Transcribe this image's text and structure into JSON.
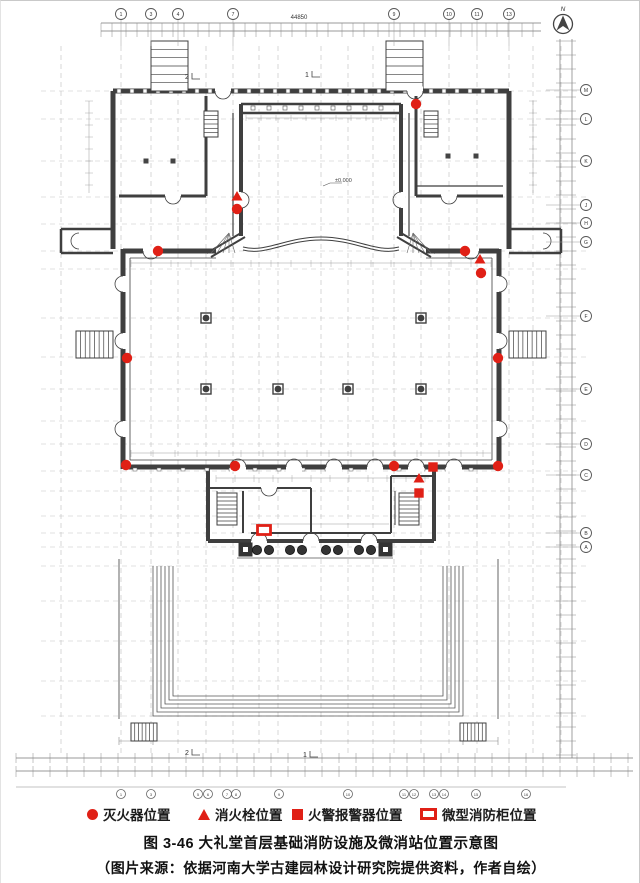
{
  "colors": {
    "red": "#e02016",
    "line": "#3f3f3f"
  },
  "compass": {
    "label": "N"
  },
  "dimensions": {
    "overall_width": "44850"
  },
  "annotations": {
    "level": "±0.000",
    "sections": [
      {
        "x": 186,
        "y": 78,
        "label": "2"
      },
      {
        "x": 306,
        "y": 76,
        "label": "1"
      },
      {
        "x": 186,
        "y": 754,
        "label": "2"
      },
      {
        "x": 304,
        "y": 756,
        "label": "1"
      }
    ]
  },
  "grid": {
    "top_bubbles": [
      {
        "x": 120,
        "label": "1"
      },
      {
        "x": 150,
        "label": "3"
      },
      {
        "x": 177,
        "label": "4"
      },
      {
        "x": 232,
        "label": "7"
      },
      {
        "x": 393,
        "label": "9"
      },
      {
        "x": 448,
        "label": "10"
      },
      {
        "x": 476,
        "label": "11"
      },
      {
        "x": 508,
        "label": "13"
      }
    ],
    "right_bubbles": [
      {
        "y": 89,
        "label": "M"
      },
      {
        "y": 118,
        "label": "L"
      },
      {
        "y": 160,
        "label": "K"
      },
      {
        "y": 204,
        "label": "J"
      },
      {
        "y": 222,
        "label": "H"
      },
      {
        "y": 241,
        "label": "G"
      },
      {
        "y": 315,
        "label": "F"
      },
      {
        "y": 388,
        "label": "E"
      },
      {
        "y": 443,
        "label": "D"
      },
      {
        "y": 474,
        "label": "C"
      },
      {
        "y": 532,
        "label": "B"
      },
      {
        "y": 546,
        "label": "A"
      }
    ],
    "bottom_bubbles": [
      {
        "x": 120,
        "label": "1"
      },
      {
        "x": 150,
        "label": "3"
      },
      {
        "x": 197,
        "label": "5"
      },
      {
        "x": 207,
        "label": "6"
      },
      {
        "x": 226,
        "label": "7"
      },
      {
        "x": 235,
        "label": "8"
      },
      {
        "x": 278,
        "label": "9"
      },
      {
        "x": 347,
        "label": "10"
      },
      {
        "x": 403,
        "label": "11"
      },
      {
        "x": 413,
        "label": "12"
      },
      {
        "x": 433,
        "label": "13"
      },
      {
        "x": 443,
        "label": "14"
      },
      {
        "x": 475,
        "label": "15"
      },
      {
        "x": 525,
        "label": "16"
      }
    ]
  },
  "markers": {
    "extinguishers": [
      [
        415,
        103
      ],
      [
        236,
        208
      ],
      [
        157,
        250
      ],
      [
        464,
        250
      ],
      [
        480,
        272
      ],
      [
        126,
        357
      ],
      [
        497,
        357
      ],
      [
        125,
        464
      ],
      [
        234,
        465
      ],
      [
        393,
        465
      ],
      [
        497,
        465
      ]
    ],
    "hydrants": [
      [
        236,
        196
      ],
      [
        479,
        259
      ],
      [
        418,
        478
      ]
    ],
    "alarms": [
      [
        432,
        466
      ],
      [
        418,
        492
      ]
    ],
    "cabinets": [
      [
        263,
        529
      ]
    ]
  },
  "legend": {
    "items": [
      {
        "symbol": "circle",
        "label": "灭火器位置"
      },
      {
        "symbol": "triangle",
        "label": "消火栓位置"
      },
      {
        "symbol": "square",
        "label": "火警报警器位置"
      },
      {
        "symbol": "cabinet",
        "label": "微型消防柜位置"
      }
    ]
  },
  "caption": "图 3-46 大礼堂首层基础消防设施及微消站位置示意图",
  "source": "（图片来源：依据河南大学古建园林设计研究院提供资料，作者自绘）"
}
